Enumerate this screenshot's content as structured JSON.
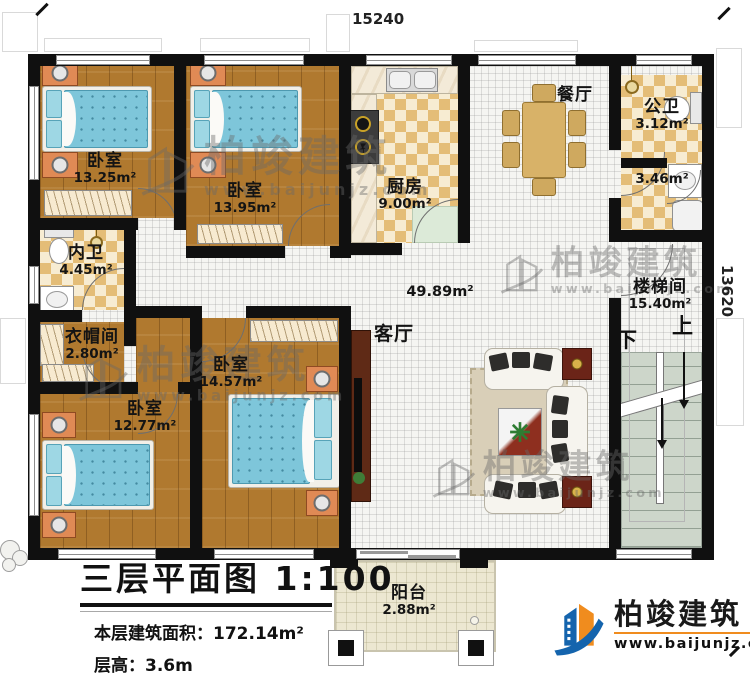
{
  "plan": {
    "dim_top": "15240",
    "dim_right": "13620",
    "rooms": {
      "bedroom_tl": {
        "name": "卧室",
        "area": "13.25m²"
      },
      "bedroom_tm": {
        "name": "卧室",
        "area": "13.95m²"
      },
      "kitchen": {
        "name": "厨房",
        "area": "9.00m²"
      },
      "dining": {
        "name": "餐厅"
      },
      "public_bath": {
        "name": "公卫",
        "area": "3.12m²"
      },
      "bath_lower": {
        "area": "3.46m²"
      },
      "inner_bath": {
        "name": "内卫",
        "area": "4.45m²"
      },
      "cloakroom": {
        "name": "衣帽间",
        "area": "2.80m²"
      },
      "bedroom_bl": {
        "name": "卧室",
        "area": "12.77m²"
      },
      "bedroom_bm": {
        "name": "卧室",
        "area": "14.57m²"
      },
      "living": {
        "name": "客厅",
        "area": "49.89m²"
      },
      "stairwell": {
        "name": "楼梯间",
        "area": "15.40m²"
      },
      "balcony": {
        "name": "阳台",
        "area": "2.88m²"
      }
    },
    "stairs": {
      "up": "上",
      "down": "下"
    }
  },
  "titleblock": {
    "title": "三层平面图",
    "scale": "1:100",
    "area_label": "本层建筑面积：",
    "area_value": "172.14m²",
    "height_label": "层高：",
    "height_value": "3.6m"
  },
  "watermark": {
    "brand": "柏竣建筑",
    "site": "www.baijunjz.com"
  },
  "logo": {
    "brand": "柏竣建筑",
    "site": "www.baijunjz.com"
  },
  "colors": {
    "wall": "#111111",
    "wood": "#b0792f",
    "tile_tan": "#e4bd77",
    "tile_cream": "#f7ecd2",
    "white_tile": "#f5f5f2",
    "stair": "#cdd6ca",
    "bed": "#7ec6da",
    "nightstand": "#e08a55",
    "accent_blue": "#1464ad",
    "accent_orange": "#f08c1e"
  }
}
